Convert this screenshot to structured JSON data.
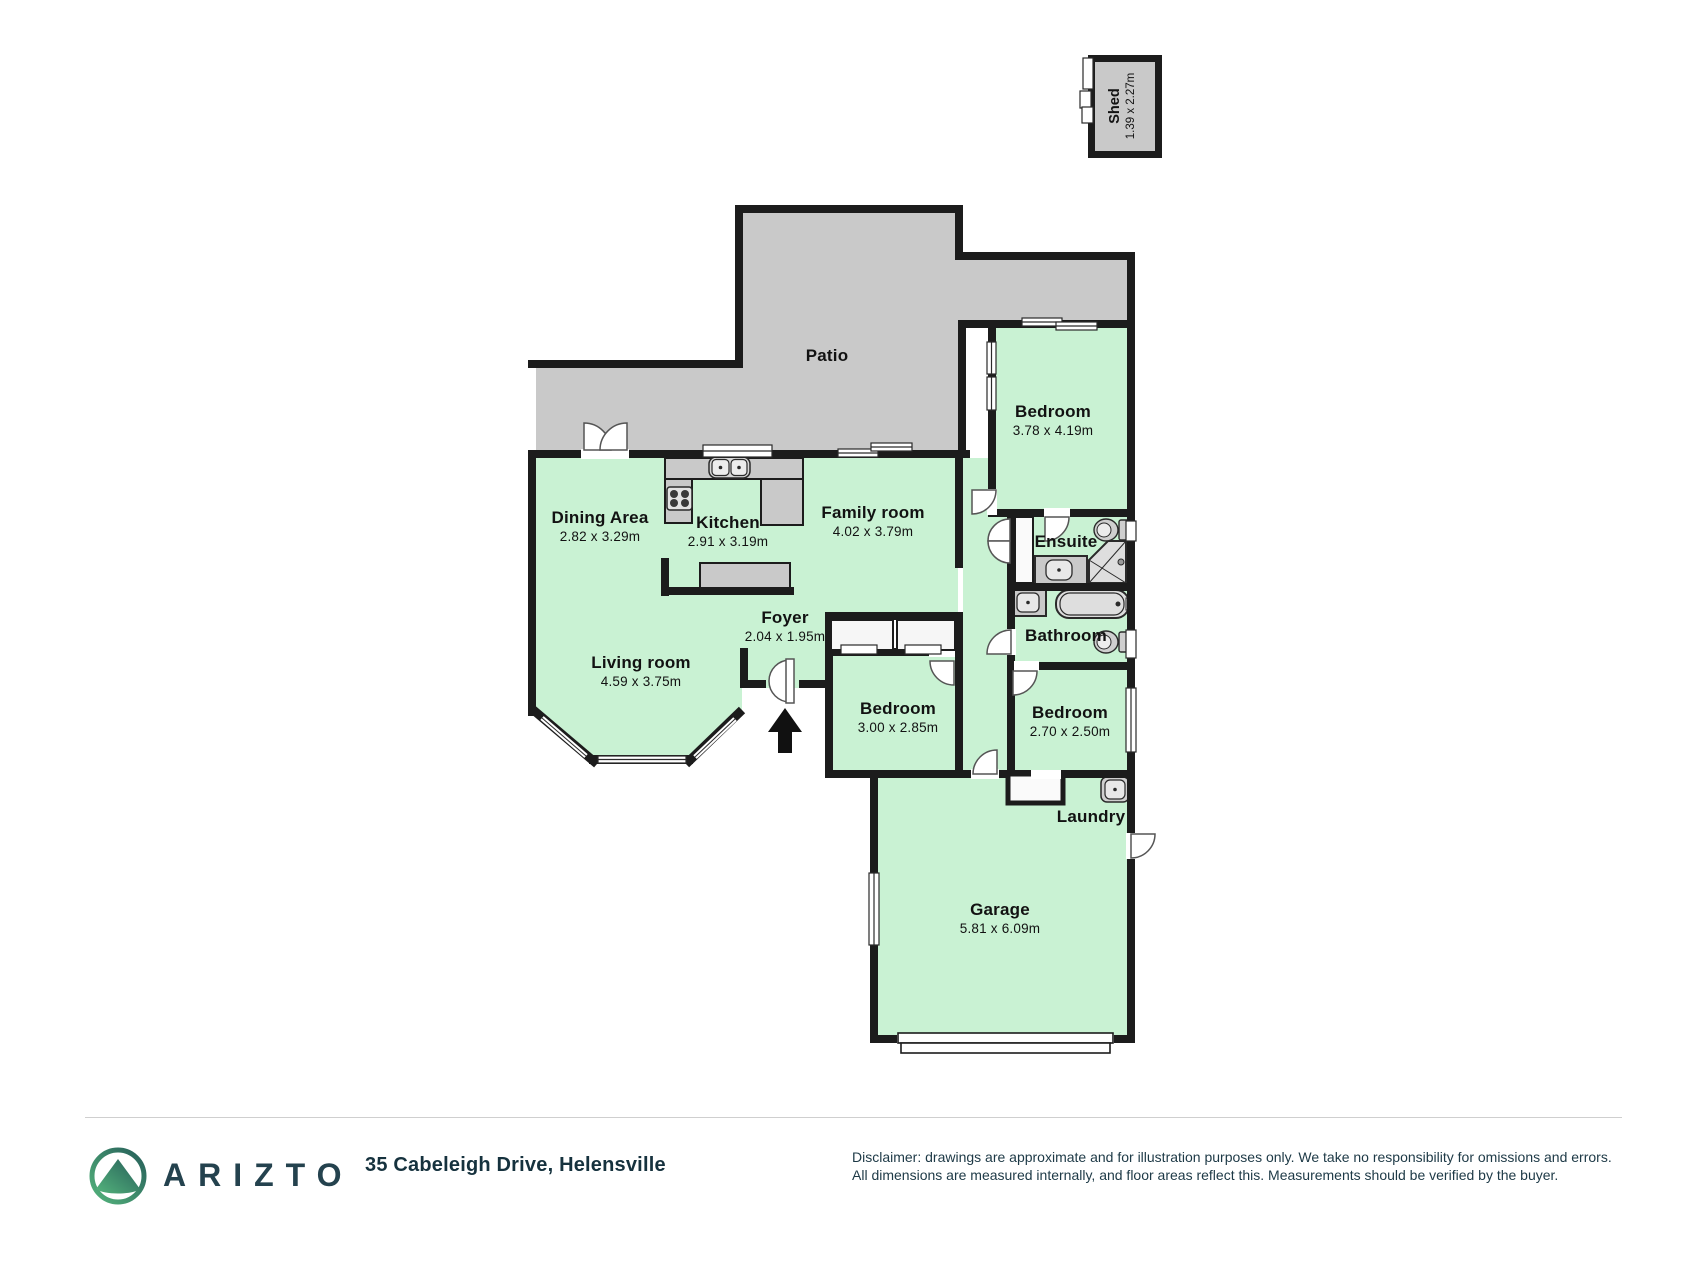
{
  "plan": {
    "rooms": [
      {
        "id": "dining",
        "name": "Dining Area",
        "dims": "2.82 x 3.29m"
      },
      {
        "id": "kitchen",
        "name": "Kitchen",
        "dims": "2.91 x 3.19m"
      },
      {
        "id": "family",
        "name": "Family room",
        "dims": "4.02 x 3.79m"
      },
      {
        "id": "living",
        "name": "Living room",
        "dims": "4.59 x 3.75m"
      },
      {
        "id": "foyer",
        "name": "Foyer",
        "dims": "2.04 x 1.95m"
      },
      {
        "id": "bedroom-main",
        "name": "Bedroom",
        "dims": "3.78 x 4.19m"
      },
      {
        "id": "ensuite",
        "name": "Ensuite",
        "dims": ""
      },
      {
        "id": "bathroom",
        "name": "Bathroom",
        "dims": ""
      },
      {
        "id": "bedroom-mid",
        "name": "Bedroom",
        "dims": "3.00 x 2.85m"
      },
      {
        "id": "bedroom-small",
        "name": "Bedroom",
        "dims": "2.70 x 2.50m"
      },
      {
        "id": "laundry",
        "name": "Laundry",
        "dims": ""
      },
      {
        "id": "garage",
        "name": "Garage",
        "dims": "5.81 x 6.09m"
      },
      {
        "id": "patio",
        "name": "Patio",
        "dims": ""
      }
    ],
    "shed": {
      "name": "Shed",
      "dims": "1.39 x 2.27m"
    }
  },
  "footer": {
    "brand": "ARIZTO",
    "address": "35 Cabeleigh Drive, Helensville",
    "disclaimer_line1": "Disclaimer: drawings are approximate and for illustration purposes only. We take no responsibility for omissions and errors.",
    "disclaimer_line2": "All dimensions are measured internally, and floor areas reflect this. Measurements should be verified by the buyer."
  },
  "colors": {
    "room_fill": "#c9f2d3",
    "outdoor_fill": "#c9c9c9",
    "wall": "#1c1c1c",
    "brand_dark": "#24424e",
    "logo_green": "#54b47c",
    "logo_teal": "#265e59"
  }
}
